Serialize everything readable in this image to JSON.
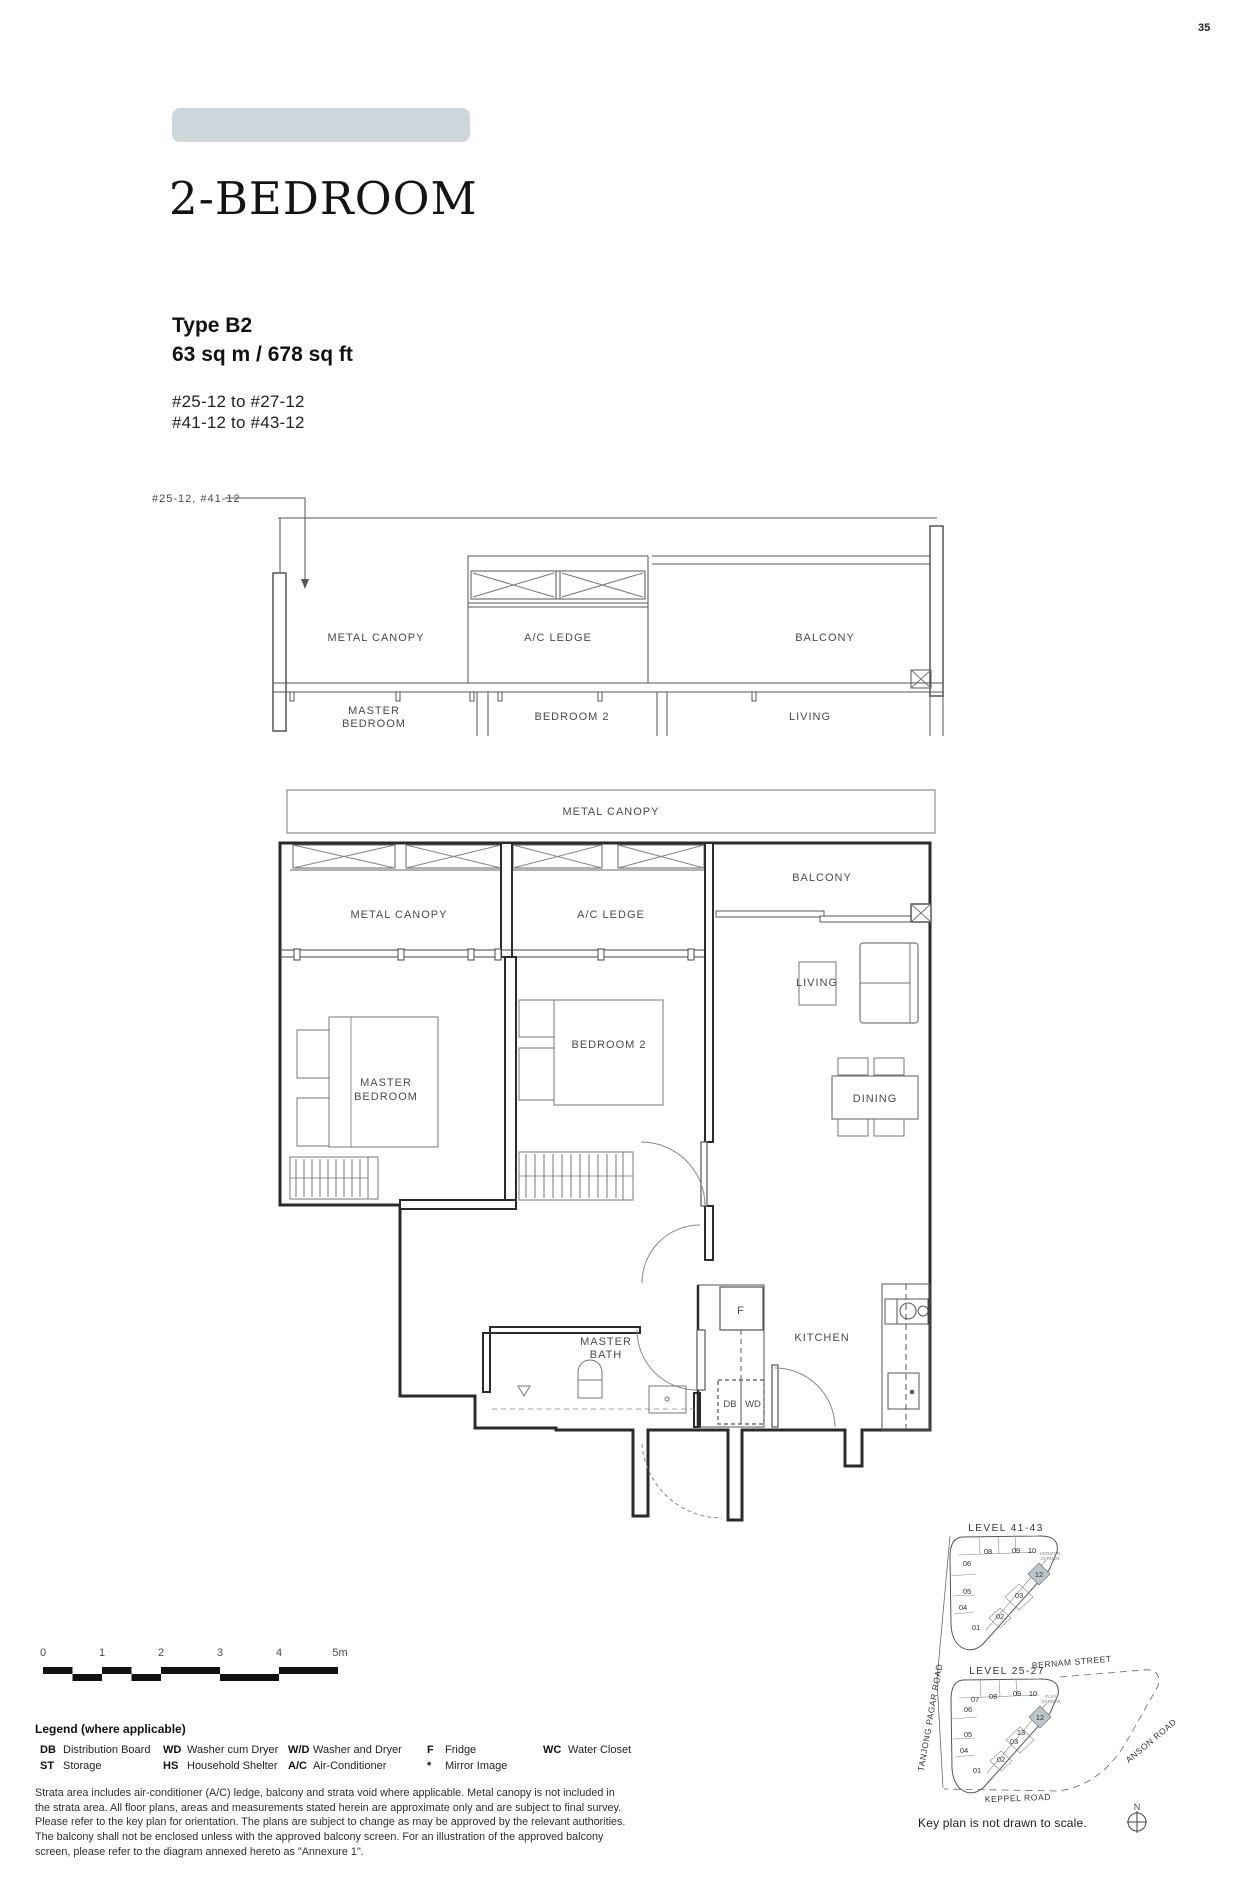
{
  "page_number": "35",
  "header": {
    "category": "2-BEDROOM",
    "type_label": "Type B2",
    "area": "63 sq m / 678 sq ft",
    "units_line1": "#25-12 to #27-12",
    "units_line2": "#41-12 to #43-12"
  },
  "colors": {
    "banner": "#cdd6db",
    "unit_highlight": "#b9c6ce"
  },
  "section": {
    "callout": "#25-12, #41-12",
    "metal_canopy": "METAL CANOPY",
    "ac_ledge": "A/C LEDGE",
    "balcony": "BALCONY",
    "master_line1": "MASTER",
    "master_line2": "BEDROOM",
    "bedroom2": "BEDROOM 2",
    "living": "LIVING"
  },
  "plan": {
    "metal_canopy_top": "METAL CANOPY",
    "metal_canopy_left": "METAL CANOPY",
    "ac_ledge": "A/C LEDGE",
    "balcony": "BALCONY",
    "master_line1": "MASTER",
    "master_line2": "BEDROOM",
    "bedroom2": "BEDROOM 2",
    "living": "LIVING",
    "dining": "DINING",
    "kitchen": "KITCHEN",
    "bath_line1": "MASTER",
    "bath_line2": "BATH",
    "fridge": "F",
    "db": "DB",
    "wd": "WD"
  },
  "scale_bar": {
    "ticks": [
      "0",
      "1",
      "2",
      "3",
      "4",
      "5m"
    ]
  },
  "legend": {
    "title": "Legend (where applicable)",
    "items": [
      {
        "abbr": "DB",
        "label": "Distribution Board"
      },
      {
        "abbr": "ST",
        "label": "Storage"
      },
      {
        "abbr": "WD",
        "label": "Washer cum Dryer"
      },
      {
        "abbr": "HS",
        "label": "Household Shelter"
      },
      {
        "abbr": "W/D",
        "label": "Washer and Dryer"
      },
      {
        "abbr": "A/C",
        "label": "Air-Conditioner"
      },
      {
        "abbr": "F",
        "label": "Fridge"
      },
      {
        "abbr": "*",
        "label": "Mirror Image"
      },
      {
        "abbr": "WC",
        "label": "Water Closet"
      }
    ]
  },
  "disclaimer": {
    "text": "Strata area includes air-conditioner (A/C) ledge, balcony and strata void where applicable. Metal canopy is not included in the strata area. All floor plans, areas and measurements stated herein are approximate only and are subject to final survey. Please refer to the key plan for orientation. The plans are subject to change as may be approved by the relevant authorities. The balcony shall not be enclosed unless with the approved balcony screen. For an illustration of the approved balcony screen, please refer to the diagram annexed hereto as \"Annexure 1\"."
  },
  "key_plan": {
    "upper_level": "LEVEL  41-43",
    "lower_level": "LEVEL  25-27",
    "upper_garden_1": "HORIZON",
    "upper_garden_2": "GARDEN",
    "lower_garden_1": "PLAY",
    "lower_garden_2": "GARDEN",
    "upper_units": [
      "08",
      "09",
      "10",
      "06",
      "12",
      "05",
      "03",
      "04",
      "02",
      "01"
    ],
    "lower_units": [
      "07",
      "08",
      "09",
      "10",
      "06",
      "12",
      "05",
      "13",
      "03",
      "04",
      "02",
      "01"
    ],
    "streets": {
      "bernam": "BERNAM STREET",
      "tanjong_pagar": "TANJONG PAGAR ROAD",
      "anson": "ANSON ROAD",
      "keppel": "KEPPEL ROAD"
    },
    "note": "Key plan is not drawn to scale.",
    "north": "N"
  }
}
